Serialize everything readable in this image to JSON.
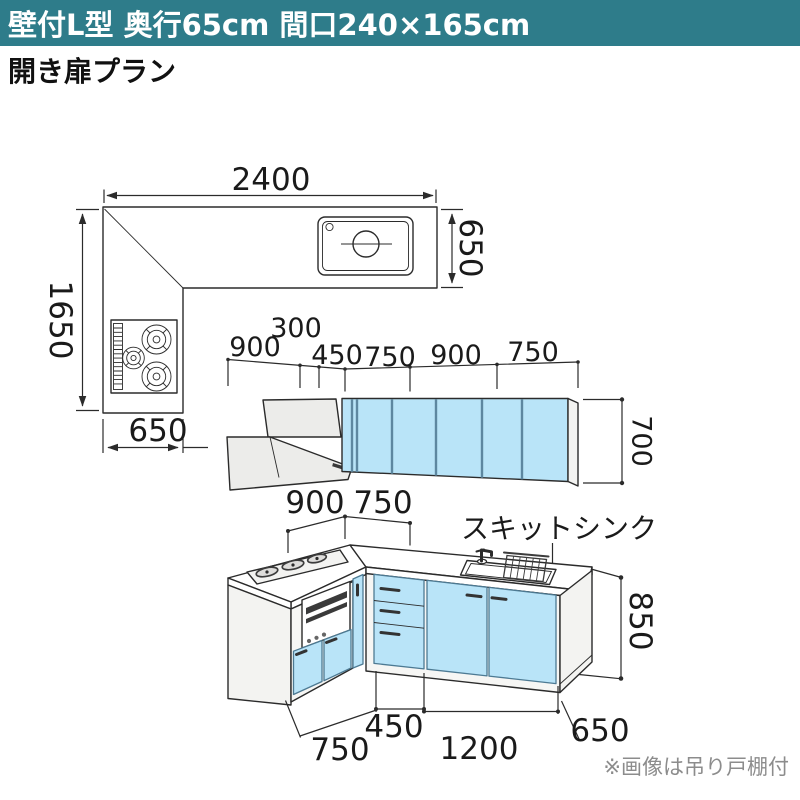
{
  "header": {
    "title": "壁付L型 奥行65cm 間口240×165cm"
  },
  "subtitle": "開き扉プラン",
  "plan_view": {
    "width_top": "2400",
    "depth_right": "650",
    "length_left": "1650",
    "depth_bottom": "650"
  },
  "elevation_view": {
    "widths": [
      "900",
      "300",
      "450",
      "750",
      "900",
      "750"
    ],
    "wall_cabinet_height": "700"
  },
  "perspective_view": {
    "upper_widths": [
      "900",
      "750"
    ],
    "sink_label": "スキットシンク",
    "lower_widths": [
      "750",
      "450",
      "1200"
    ],
    "depth": "650",
    "counter_height": "850"
  },
  "footnote": "※画像は吊り戸棚付",
  "colors": {
    "header_bg": "#2e7c8a",
    "header_text": "#ffffff",
    "cabinet_blue": "#b9e4f8",
    "cabinet_divider": "#5d87a0",
    "line": "#2b2b2b",
    "panel_gray": "#ececea",
    "footnote_gray": "#8c8c8c"
  }
}
